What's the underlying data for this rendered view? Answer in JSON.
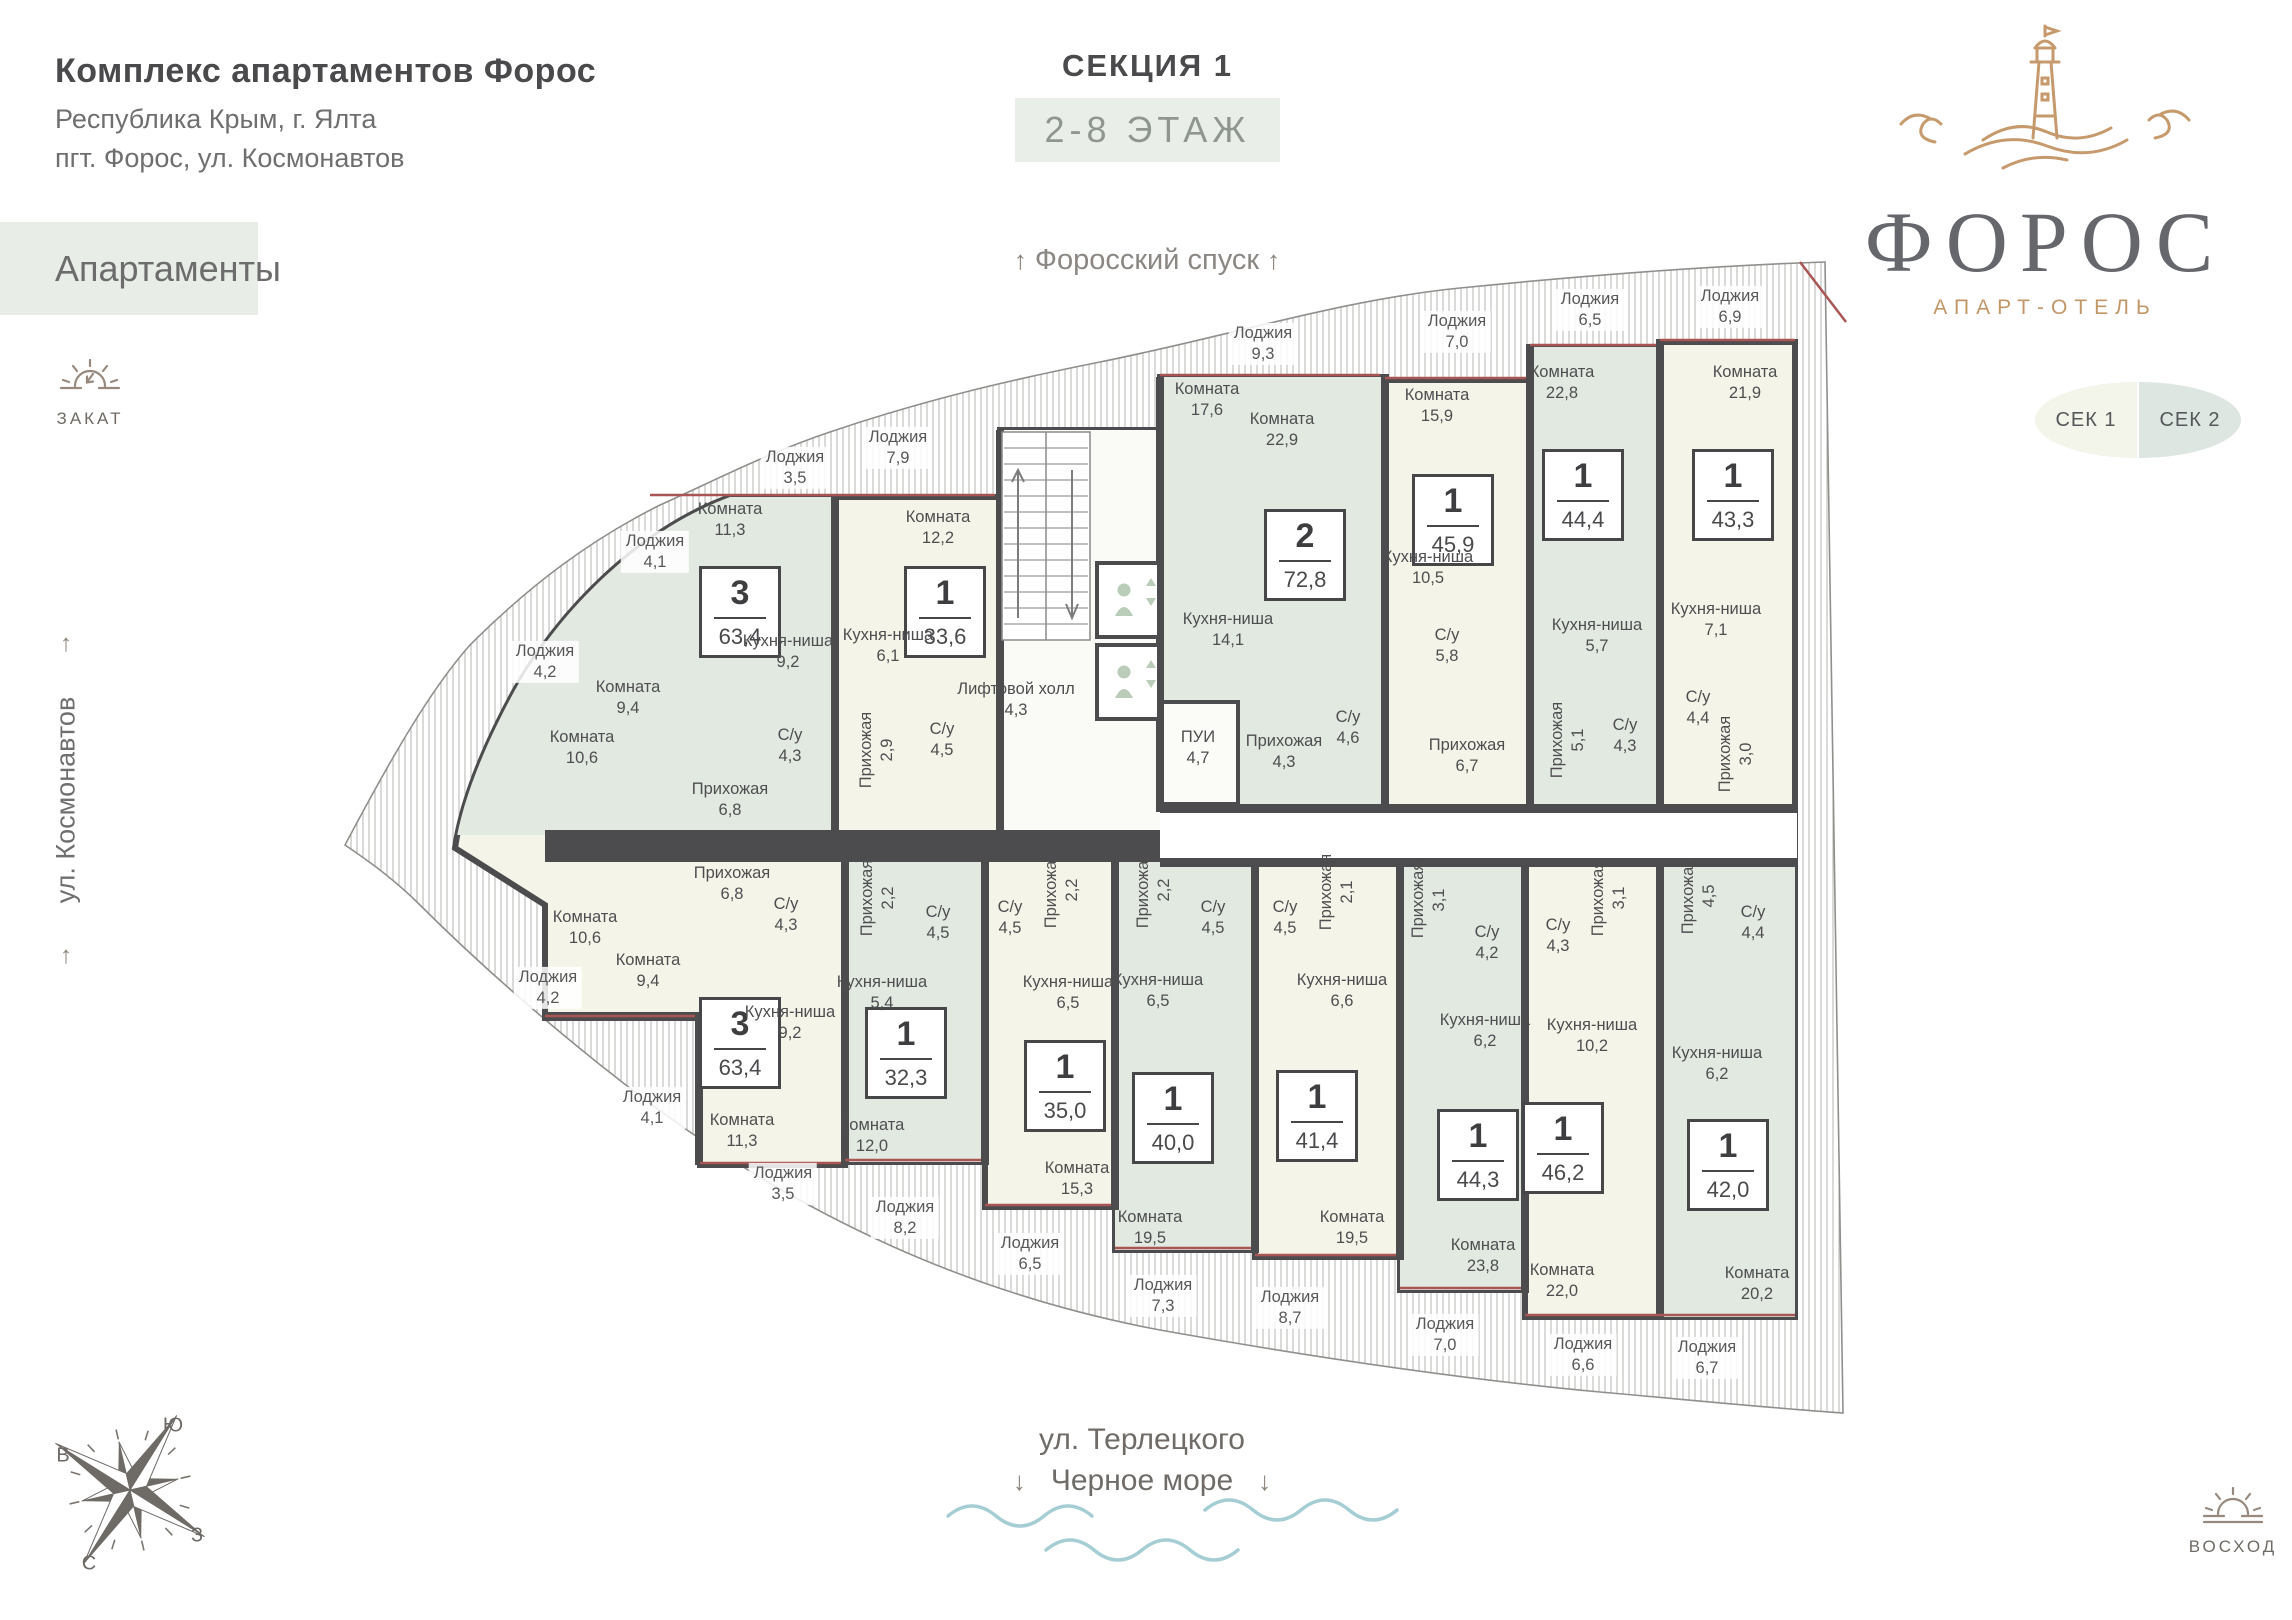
{
  "header": {
    "title": "Комплекс апартаментов Форос",
    "address1": "Республика Крым, г. Ялта",
    "address2": "пгт. Форос, ул. Космонавтов",
    "tag": "Апартаменты"
  },
  "section": {
    "title": "СЕКЦИЯ 1",
    "floors": "2-8 ЭТАЖ"
  },
  "logo": {
    "name": "ФОРОС",
    "subtitle": "АПАРТ-ОТЕЛЬ"
  },
  "section_buttons": {
    "sek1": "СЕК 1",
    "sek2": "СЕК 2"
  },
  "streets": {
    "top": "Форосский спуск",
    "left": "ул. Космонавтов",
    "bottom_line1": "ул. Терлецкого",
    "bottom_line2": "Черное море"
  },
  "markers": {
    "sunset": "ЗАКАТ",
    "sunrise": "ВОСХОД"
  },
  "compass": {
    "north": "С",
    "south": "Ю",
    "east": "В",
    "west": "З"
  },
  "colors": {
    "wall": "#4c4c4e",
    "green": "#e2e9e1",
    "cream": "#f4f4e8",
    "gold": "#c69a6c",
    "wave": "#a5ced4",
    "window_red": "#a85553"
  },
  "floor_plan": {
    "core": {
      "lift_hall": {
        "label": "Лифтовой холл",
        "area": "4,3",
        "x": 1016,
        "y": 700
      },
      "pui": {
        "label": "ПУИ",
        "area": "4,7",
        "x": 1198,
        "y": 748
      }
    },
    "apartments": [
      {
        "rooms_count": "3",
        "total_area": "63,4",
        "badge": {
          "x": 740,
          "y": 612
        },
        "rooms": [
          {
            "label": "Комната",
            "area": "11,3",
            "x": 730,
            "y": 520
          },
          {
            "label": "Кухня-ниша",
            "area": "9,2",
            "x": 788,
            "y": 652
          },
          {
            "label": "Комната",
            "area": "9,4",
            "x": 628,
            "y": 698
          },
          {
            "label": "Комната",
            "area": "10,6",
            "x": 582,
            "y": 748
          },
          {
            "label": "С/у",
            "area": "4,3",
            "x": 790,
            "y": 746
          },
          {
            "label": "Прихожая",
            "area": "6,8",
            "x": 730,
            "y": 800
          },
          {
            "label": "Лоджия",
            "area": "4,1",
            "x": 655,
            "y": 552,
            "loggia": true
          },
          {
            "label": "Лоджия",
            "area": "4,2",
            "x": 545,
            "y": 662,
            "loggia": true
          },
          {
            "label": "Лоджия",
            "area": "3,5",
            "x": 795,
            "y": 468,
            "loggia": true
          }
        ]
      },
      {
        "rooms_count": "1",
        "total_area": "33,6",
        "badge": {
          "x": 945,
          "y": 612
        },
        "rooms": [
          {
            "label": "Комната",
            "area": "12,2",
            "x": 938,
            "y": 528
          },
          {
            "label": "Кухня-ниша",
            "area": "6,1",
            "x": 888,
            "y": 646
          },
          {
            "label": "Прихожая",
            "area": "2,9",
            "x": 877,
            "y": 750,
            "vertical": true
          },
          {
            "label": "С/у",
            "area": "4,5",
            "x": 942,
            "y": 740
          },
          {
            "label": "Лоджия",
            "area": "7,9",
            "x": 898,
            "y": 448,
            "loggia": true
          }
        ]
      },
      {
        "rooms_count": "2",
        "total_area": "72,8",
        "badge": {
          "x": 1305,
          "y": 555
        },
        "rooms": [
          {
            "label": "Комната",
            "area": "17,6",
            "x": 1207,
            "y": 400
          },
          {
            "label": "Комната",
            "area": "22,9",
            "x": 1282,
            "y": 430
          },
          {
            "label": "Кухня-ниша",
            "area": "14,1",
            "x": 1228,
            "y": 630
          },
          {
            "label": "С/у",
            "area": "4,6",
            "x": 1348,
            "y": 728
          },
          {
            "label": "Прихожая",
            "area": "4,3",
            "x": 1284,
            "y": 752
          },
          {
            "label": "Лоджия",
            "area": "9,3",
            "x": 1263,
            "y": 344,
            "loggia": true
          }
        ]
      },
      {
        "rooms_count": "1",
        "total_area": "45,9",
        "badge": {
          "x": 1453,
          "y": 520
        },
        "rooms": [
          {
            "label": "Комната",
            "area": "15,9",
            "x": 1437,
            "y": 406
          },
          {
            "label": "Кухня-ниша",
            "area": "10,5",
            "x": 1428,
            "y": 568
          },
          {
            "label": "С/у",
            "area": "5,8",
            "x": 1447,
            "y": 646
          },
          {
            "label": "Прихожая",
            "area": "6,7",
            "x": 1467,
            "y": 756
          },
          {
            "label": "Лоджия",
            "area": "7,0",
            "x": 1457,
            "y": 332,
            "loggia": true
          }
        ]
      },
      {
        "rooms_count": "1",
        "total_area": "44,4",
        "badge": {
          "x": 1583,
          "y": 495
        },
        "rooms": [
          {
            "label": "Комната",
            "area": "22,8",
            "x": 1562,
            "y": 383
          },
          {
            "label": "Кухня-ниша",
            "area": "5,7",
            "x": 1597,
            "y": 636
          },
          {
            "label": "Прихожая",
            "area": "5,1",
            "x": 1568,
            "y": 740,
            "vertical": true
          },
          {
            "label": "С/у",
            "area": "4,3",
            "x": 1625,
            "y": 736
          },
          {
            "label": "Лоджия",
            "area": "6,5",
            "x": 1590,
            "y": 310,
            "loggia": true
          }
        ]
      },
      {
        "rooms_count": "1",
        "total_area": "43,3",
        "badge": {
          "x": 1733,
          "y": 495
        },
        "rooms": [
          {
            "label": "Комната",
            "area": "21,9",
            "x": 1745,
            "y": 383
          },
          {
            "label": "Кухня-ниша",
            "area": "7,1",
            "x": 1716,
            "y": 620
          },
          {
            "label": "С/у",
            "area": "4,4",
            "x": 1698,
            "y": 708
          },
          {
            "label": "Прихожая",
            "area": "3,0",
            "x": 1736,
            "y": 754,
            "vertical": true
          },
          {
            "label": "Лоджия",
            "area": "6,9",
            "x": 1730,
            "y": 307,
            "loggia": true
          }
        ]
      },
      {
        "rooms_count": "3",
        "total_area": "63,4",
        "badge": {
          "x": 740,
          "y": 1043
        },
        "rooms": [
          {
            "label": "Прихожая",
            "area": "6,8",
            "x": 732,
            "y": 884
          },
          {
            "label": "Комната",
            "area": "10,6",
            "x": 585,
            "y": 928
          },
          {
            "label": "С/у",
            "area": "4,3",
            "x": 786,
            "y": 915
          },
          {
            "label": "Комната",
            "area": "9,4",
            "x": 648,
            "y": 971
          },
          {
            "label": "Кухня-ниша",
            "area": "9,2",
            "x": 790,
            "y": 1023
          },
          {
            "label": "Комната",
            "area": "11,3",
            "x": 742,
            "y": 1131
          },
          {
            "label": "Лоджия",
            "area": "4,2",
            "x": 548,
            "y": 988,
            "loggia": true
          },
          {
            "label": "Лоджия",
            "area": "4,1",
            "x": 652,
            "y": 1108,
            "loggia": true
          },
          {
            "label": "Лоджия",
            "area": "3,5",
            "x": 783,
            "y": 1184,
            "loggia": true
          }
        ]
      },
      {
        "rooms_count": "1",
        "total_area": "32,3",
        "badge": {
          "x": 906,
          "y": 1053
        },
        "rooms": [
          {
            "label": "Прихожая",
            "area": "2,2",
            "x": 878,
            "y": 898,
            "vertical": true
          },
          {
            "label": "С/у",
            "area": "4,5",
            "x": 938,
            "y": 923
          },
          {
            "label": "Кухня-ниша",
            "area": "5,4",
            "x": 882,
            "y": 993
          },
          {
            "label": "Комната",
            "area": "12,0",
            "x": 872,
            "y": 1136
          },
          {
            "label": "Лоджия",
            "area": "8,2",
            "x": 905,
            "y": 1218,
            "loggia": true
          }
        ]
      },
      {
        "rooms_count": "1",
        "total_area": "35,0",
        "badge": {
          "x": 1065,
          "y": 1086
        },
        "rooms": [
          {
            "label": "С/у",
            "area": "4,5",
            "x": 1010,
            "y": 918
          },
          {
            "label": "Прихожая",
            "area": "2,2",
            "x": 1062,
            "y": 890,
            "vertical": true
          },
          {
            "label": "Кухня-ниша",
            "area": "6,5",
            "x": 1068,
            "y": 993
          },
          {
            "label": "Комната",
            "area": "15,3",
            "x": 1077,
            "y": 1179
          },
          {
            "label": "Лоджия",
            "area": "6,5",
            "x": 1030,
            "y": 1254,
            "loggia": true
          }
        ]
      },
      {
        "rooms_count": "1",
        "total_area": "40,0",
        "badge": {
          "x": 1173,
          "y": 1118
        },
        "rooms": [
          {
            "label": "Прихожая",
            "area": "2,2",
            "x": 1154,
            "y": 890,
            "vertical": true
          },
          {
            "label": "С/у",
            "area": "4,5",
            "x": 1213,
            "y": 918
          },
          {
            "label": "Кухня-ниша",
            "area": "6,5",
            "x": 1158,
            "y": 991
          },
          {
            "label": "Комната",
            "area": "19,5",
            "x": 1150,
            "y": 1228
          },
          {
            "label": "Лоджия",
            "area": "7,3",
            "x": 1163,
            "y": 1296,
            "loggia": true
          }
        ]
      },
      {
        "rooms_count": "1",
        "total_area": "41,4",
        "badge": {
          "x": 1317,
          "y": 1116
        },
        "rooms": [
          {
            "label": "С/у",
            "area": "4,5",
            "x": 1285,
            "y": 918
          },
          {
            "label": "Прихожая",
            "area": "2,1",
            "x": 1337,
            "y": 892,
            "vertical": true
          },
          {
            "label": "Кухня-ниша",
            "area": "6,6",
            "x": 1342,
            "y": 991
          },
          {
            "label": "Комната",
            "area": "19,5",
            "x": 1352,
            "y": 1228
          },
          {
            "label": "Лоджия",
            "area": "8,7",
            "x": 1290,
            "y": 1308,
            "loggia": true
          }
        ]
      },
      {
        "rooms_count": "1",
        "total_area": "44,3",
        "badge": {
          "x": 1478,
          "y": 1155
        },
        "rooms": [
          {
            "label": "Прихожая",
            "area": "3,1",
            "x": 1429,
            "y": 900,
            "vertical": true
          },
          {
            "label": "С/у",
            "area": "4,2",
            "x": 1487,
            "y": 943
          },
          {
            "label": "Кухня-ниша",
            "area": "6,2",
            "x": 1485,
            "y": 1031
          },
          {
            "label": "Комната",
            "area": "23,8",
            "x": 1483,
            "y": 1256
          },
          {
            "label": "Лоджия",
            "area": "7,0",
            "x": 1445,
            "y": 1335,
            "loggia": true
          }
        ]
      },
      {
        "rooms_count": "1",
        "total_area": "46,2",
        "badge": {
          "x": 1563,
          "y": 1148
        },
        "rooms": [
          {
            "label": "С/у",
            "area": "4,3",
            "x": 1558,
            "y": 936
          },
          {
            "label": "Прихожая",
            "area": "3,1",
            "x": 1609,
            "y": 898,
            "vertical": true
          },
          {
            "label": "Кухня-ниша",
            "area": "10,2",
            "x": 1592,
            "y": 1036
          },
          {
            "label": "Комната",
            "area": "22,0",
            "x": 1562,
            "y": 1281
          },
          {
            "label": "Лоджия",
            "area": "6,6",
            "x": 1583,
            "y": 1355,
            "loggia": true
          }
        ]
      },
      {
        "rooms_count": "1",
        "total_area": "42,0",
        "badge": {
          "x": 1728,
          "y": 1165
        },
        "rooms": [
          {
            "label": "Прихожая",
            "area": "4,5",
            "x": 1699,
            "y": 896,
            "vertical": true
          },
          {
            "label": "С/у",
            "area": "4,4",
            "x": 1753,
            "y": 923
          },
          {
            "label": "Кухня-ниша",
            "area": "6,2",
            "x": 1717,
            "y": 1064
          },
          {
            "label": "Комната",
            "area": "20,2",
            "x": 1757,
            "y": 1284
          },
          {
            "label": "Лоджия",
            "area": "6,7",
            "x": 1707,
            "y": 1358,
            "loggia": true
          }
        ]
      }
    ]
  }
}
